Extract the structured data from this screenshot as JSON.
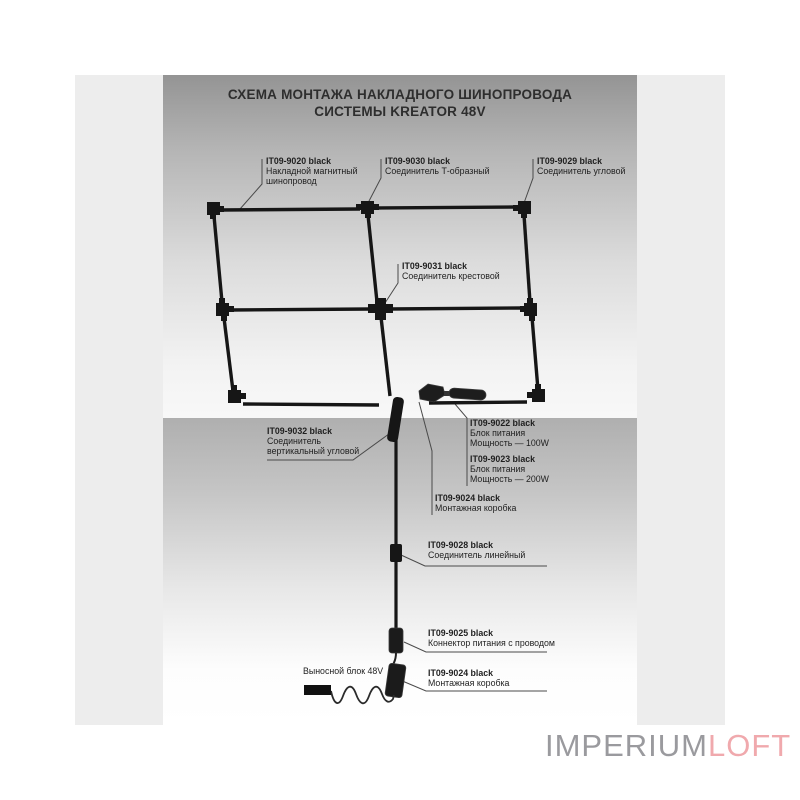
{
  "title": {
    "line1": "СХЕМА  МОНТАЖА НАКЛАДНОГО ШИНОПРОВОДА",
    "line2": "СИСТЕМЫ KREATOR 48V"
  },
  "parts": {
    "l9020": {
      "code": "IT09-9020 black",
      "desc1": "Накладной магнитный",
      "desc2": "шинопровод"
    },
    "l9030": {
      "code": "IT09-9030 black",
      "desc1": "Соединитель Т-образный"
    },
    "l9029": {
      "code": "IT09-9029 black",
      "desc1": "Соединитель угловой"
    },
    "l9031": {
      "code": "IT09-9031 black",
      "desc1": "Соединитель крестовой"
    },
    "l9032": {
      "code": "IT09-9032 black",
      "desc1": "Соединитель",
      "desc2": "вертикальный угловой"
    },
    "l9022": {
      "code": "IT09-9022 black",
      "desc1": "Блок питания",
      "desc2": "Мощность — 100W"
    },
    "l9023": {
      "code": "IT09-9023 black",
      "desc1": "Блок питания",
      "desc2": "Мощность — 200W"
    },
    "l9024a": {
      "code": "IT09-9024 black",
      "desc1": "Монтажная коробка"
    },
    "l9028": {
      "code": "IT09-9028 black",
      "desc1": "Соединитель линейный"
    },
    "l9025": {
      "code": "IT09-9025 black",
      "desc1": "Коннектор питания с проводом"
    },
    "l9024b": {
      "code": "IT09-9024 black",
      "desc1": "Монтажная коробка"
    },
    "remote": {
      "desc1": "Выносной блок 48V"
    }
  },
  "watermark": {
    "gray_part": "IMPERIUM",
    "pink_part": "LOFT"
  },
  "colors": {
    "track": "#161616",
    "label_text": "#1f1f1f",
    "leader_line": "#4a4a4a",
    "watermark_gray": "#9a9a9e",
    "watermark_pink": "#f0a9ad",
    "photo_background": "#ededed"
  }
}
